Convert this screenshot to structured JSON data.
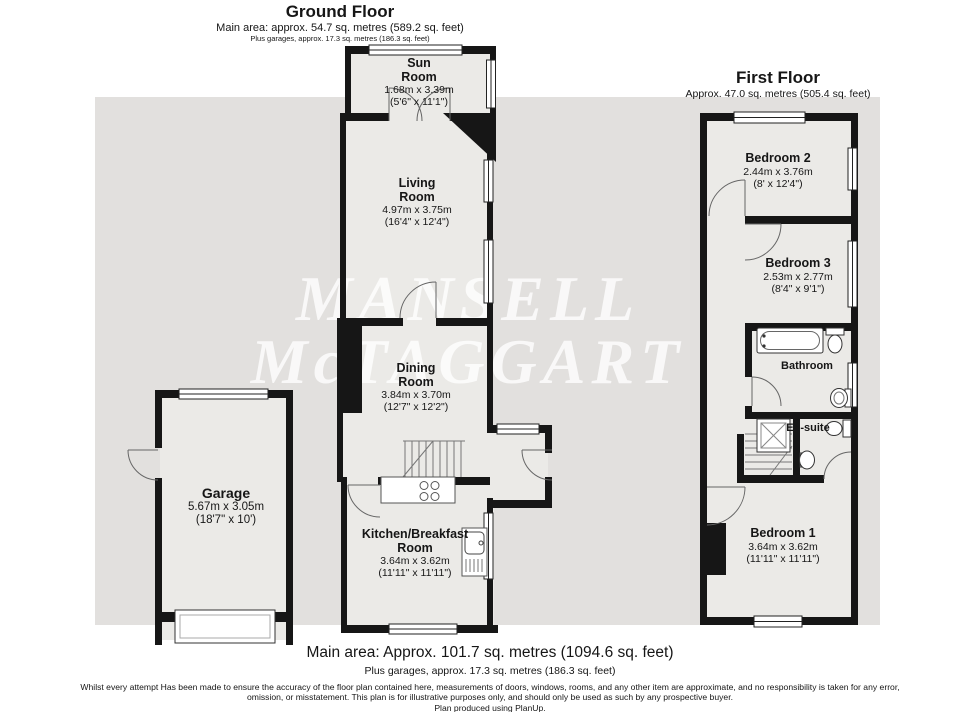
{
  "ground_floor": {
    "title": "Ground Floor",
    "area_line": "Main area: approx. 54.7 sq. metres (589.2 sq. feet)",
    "garage_line": "Plus garages, approx. 17.3 sq. metres (186.3 sq. feet)",
    "rooms": {
      "sun": {
        "name": "Sun\nRoom",
        "metric": "1.68m x 3.39m",
        "imperial": "(5'6\" x 11'1\")"
      },
      "living": {
        "name": "Living\nRoom",
        "metric": "4.97m x 3.75m",
        "imperial": "(16'4\" x 12'4\")"
      },
      "dining": {
        "name": "Dining\nRoom",
        "metric": "3.84m x 3.70m",
        "imperial": "(12'7\" x 12'2\")"
      },
      "kitchen": {
        "name": "Kitchen/Breakfast\nRoom",
        "metric": "3.64m x 3.62m",
        "imperial": "(11'11\" x 11'11\")"
      },
      "garage": {
        "name": "Garage",
        "metric": "5.67m x 3.05m",
        "imperial": "(18'7\" x 10')"
      }
    }
  },
  "first_floor": {
    "title": "First Floor",
    "area_line": "Approx. 47.0 sq. metres (505.4 sq. feet)",
    "rooms": {
      "bedroom2": {
        "name": "Bedroom 2",
        "metric": "2.44m x 3.76m",
        "imperial": "(8' x 12'4\")"
      },
      "bedroom3": {
        "name": "Bedroom 3",
        "metric": "2.53m x 2.77m",
        "imperial": "(8'4\" x 9'1\")"
      },
      "bathroom": {
        "name": "Bathroom"
      },
      "ensuite": {
        "name": "En-suite"
      },
      "bedroom1": {
        "name": "Bedroom 1",
        "metric": "3.64m x 3.62m",
        "imperial": "(11'11\" x 11'11\")"
      }
    }
  },
  "watermark": {
    "line1": "MANSELL",
    "line2": "McTAGGART"
  },
  "footer": {
    "main_area": "Main area: Approx. 101.7 sq. metres (1094.6 sq. feet)",
    "plus_garages": "Plus garages, approx. 17.3 sq. metres (186.3 sq. feet)",
    "disclaimer": "Whilst every attempt Has been made to ensure the accuracy of the floor plan contained here, measurements of doors, windows, rooms, and any other item are approximate, and no responsibility is taken for any error, omission, or misstatement. This plan is for illustrative purposes only, and should only be used as such by any prospective buyer.",
    "produced": "Plan produced using PlanUp."
  },
  "icons": [
    "stairs-icon",
    "bath-icon",
    "toilet-icon",
    "sink-icon",
    "shower-icon",
    "hob-icon",
    "door-arc-icon",
    "window-icon",
    "garage-door-icon"
  ],
  "colors": {
    "wall": "#161616",
    "backdrop": "#e2e0de",
    "room_fill": "#ebeae7",
    "fixture_line": "#555555",
    "watermark": "rgba(255,255,255,0.78)"
  }
}
